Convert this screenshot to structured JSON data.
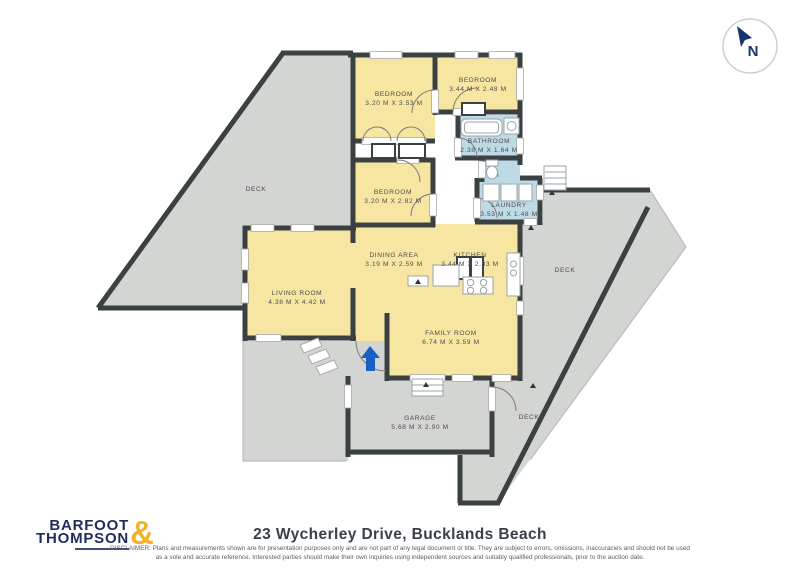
{
  "compass": {
    "label": "N"
  },
  "rooms": {
    "bedroom1": {
      "name": "BEDROOM",
      "dims": "3.20 M X 3.53 M"
    },
    "bedroom2": {
      "name": "BEDROOM",
      "dims": "3.44 M X 2.48 M"
    },
    "bathroom": {
      "name": "BATHROOM",
      "dims": "2.38 M X 1.64 M"
    },
    "bedroom3": {
      "name": "BEDROOM",
      "dims": "3.20 M X 2.82 M"
    },
    "laundry": {
      "name": "LAUNDRY",
      "dims": "3.53 M X 1.48 M"
    },
    "dining": {
      "name": "DINING AREA",
      "dims": "3.19 M X 2.59 M"
    },
    "kitchen": {
      "name": "KITCHEN",
      "dims": "3.44 M X 2.83 M"
    },
    "living": {
      "name": "LIVING ROOM",
      "dims": "4.38 M X 4.42 M"
    },
    "family": {
      "name": "FAMILY ROOM",
      "dims": "6.74 M X 3.59 M"
    },
    "garage": {
      "name": "GARAGE",
      "dims": "5.68 M X 2.90 M"
    },
    "deck_left": {
      "name": "DECK"
    },
    "deck_right": {
      "name": "DECK"
    },
    "deck_bottom": {
      "name": "DECK"
    }
  },
  "footer": {
    "title": "23 Wycherley Drive, Bucklands Beach",
    "disclaimer_line1": "DISCLAIMER: Plans and measurements shown are for presentation purposes only and are not part of any legal document or title. They are subject to errors, omissions, inaccuracies and should not be used",
    "disclaimer_line2": "as a sole and accurate reference. Interested parties should make their own inquiries using independent sources and suitably qualified professionals, prior to the auction date.",
    "logo": {
      "line1": "BARFOOT",
      "line2": "THOMPSON",
      "amp": "&"
    }
  },
  "colors": {
    "room_yellow": "#F7E6A2",
    "wet_area_blue": "#BEDAE6",
    "deck_gray": "#D3D5D2",
    "wall_dark": "#3B4143",
    "entry_arrow_blue": "#1A60C4",
    "brand_navy": "#1D2D5C",
    "brand_gold": "#F2B32B"
  }
}
